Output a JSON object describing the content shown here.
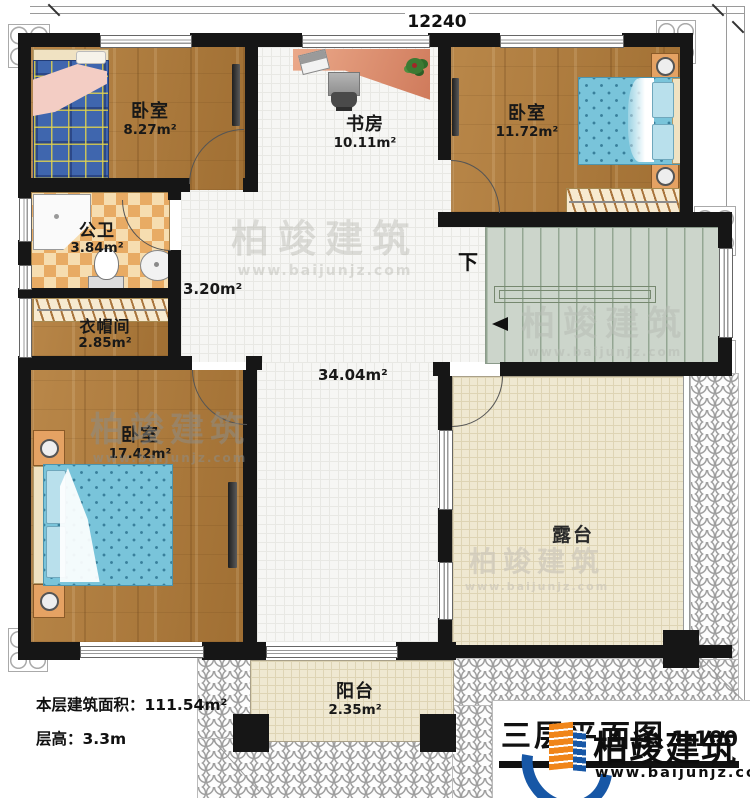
{
  "dimensions": {
    "top": "12240",
    "right": "12320"
  },
  "rooms": {
    "bedroom1": {
      "name": "卧室",
      "area": "8.27m²"
    },
    "study": {
      "name": "书房",
      "area": "10.11m²"
    },
    "bedroom2": {
      "name": "卧室",
      "area": "11.72m²"
    },
    "bathroom": {
      "name": "公卫",
      "area": "3.84m²"
    },
    "cloakroom": {
      "name": "衣帽间",
      "area": "2.85m²"
    },
    "bedroom3": {
      "name": "卧室",
      "area": "17.42m²"
    },
    "corridor_area": "3.20m²",
    "hall_area": "34.04m²",
    "terrace": {
      "name": "露台"
    },
    "balcony": {
      "name": "阳台",
      "area": "2.35m²"
    },
    "stairs": {
      "direction_label": "下"
    }
  },
  "annotations": {
    "floor_area_label": "本层建筑面积：",
    "floor_area_value": "111.54m²",
    "floor_height_label": "层高：",
    "floor_height_value": "3.3m"
  },
  "title_block": {
    "title": "三层平面图",
    "scale": "1:100"
  },
  "branding": {
    "name": "柏竣建筑",
    "url": "www.baijunjz.com"
  },
  "colors": {
    "wall": "#161616",
    "wood_floor": "#ad7a3e",
    "white_tile": "#f6f6f4",
    "terrace_floor": "#efe8d1",
    "stairs_floor": "#ccd5cb",
    "bathroom_tile": "#e8ab64",
    "bed_plaid_blue": "#3f66ae",
    "bed_dot_blue": "#79c4da",
    "logo_blue": "#1757a6",
    "logo_orange": "#f08519"
  }
}
